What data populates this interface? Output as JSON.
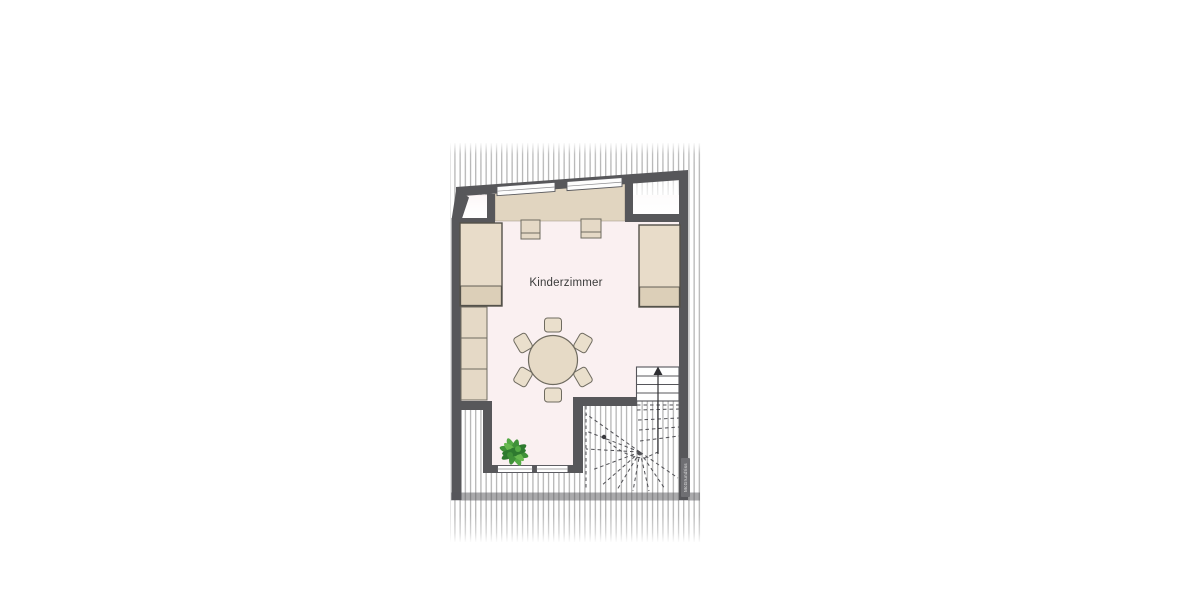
{
  "floorplan": {
    "room_label": "Kinderzimmer",
    "watermark": "McGrundriss",
    "colors": {
      "wall": "#57575a",
      "floor_room": "#faf0f1",
      "furniture_fill": "#e5d9c6",
      "furniture_fill_dark": "#dccfb8",
      "hatch_line": "#b3b3b3",
      "window_fill": "#fdfdfd",
      "plant_green": "#3f9138",
      "stair_line": "#4f4f54"
    },
    "legend": [
      "sloped-roof-hatch-area",
      "top-dormer-window-left",
      "top-dormer-window-right",
      "window-sill-shelf",
      "bed-left",
      "bed-right",
      "nightstand-left",
      "nightstand-right",
      "wardrobe-shelf",
      "round-table",
      "six-chairs",
      "potted-plant",
      "bay-window-left",
      "bay-window-right",
      "winder-staircase",
      "stair-up-arrow"
    ]
  }
}
